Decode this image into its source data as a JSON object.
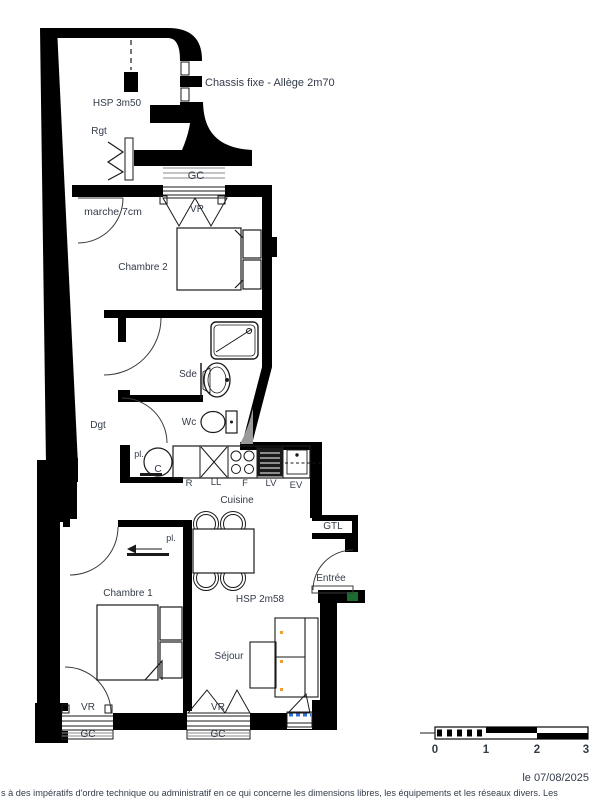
{
  "plan": {
    "annotations": {
      "chassis_fixe": "Chassis fixe - Allège 2m70",
      "hsp_top": "HSP 3m50",
      "rgt": "Rgt",
      "gc_top": "GC",
      "vr_top": "VR",
      "marche": "marche 7cm",
      "chambre2": "Chambre 2",
      "sde": "Sde",
      "wc": "Wc",
      "dgt": "Dgt",
      "pl_cuisine": "pl.",
      "chauffe_eau": "C",
      "refrigerateur": "R",
      "lave_linge": "LL",
      "four": "F",
      "lave_vaisselle": "LV",
      "evier": "EV",
      "cuisine": "Cuisine",
      "gtl": "GTL",
      "pl_chambre1": "pl.",
      "entree": "Entrée",
      "chambre1": "Chambre 1",
      "hsp_main": "HSP 2m58",
      "sejour": "Séjour",
      "vr_chambre1": "VR",
      "gc_chambre1": "GC",
      "vr_sejour": "VR",
      "gc_sejour": "GC"
    },
    "colors": {
      "walls": "#000000",
      "labels": "#333b49",
      "glazing_blue": "#2e6fd8",
      "door_green": "#1c6b30",
      "sofa_dots_orange": "#f0a030",
      "shading_gray": "#9a9a9a"
    }
  },
  "scale_bar": {
    "ticks": [
      "0",
      "1",
      "2",
      "3"
    ]
  },
  "date_label": "le 07/08/2025",
  "footer_text": "s à des impératifs d'ordre technique ou administratif en ce qui concerne les dimensions libres, les équipements et les réseaux divers. Les"
}
